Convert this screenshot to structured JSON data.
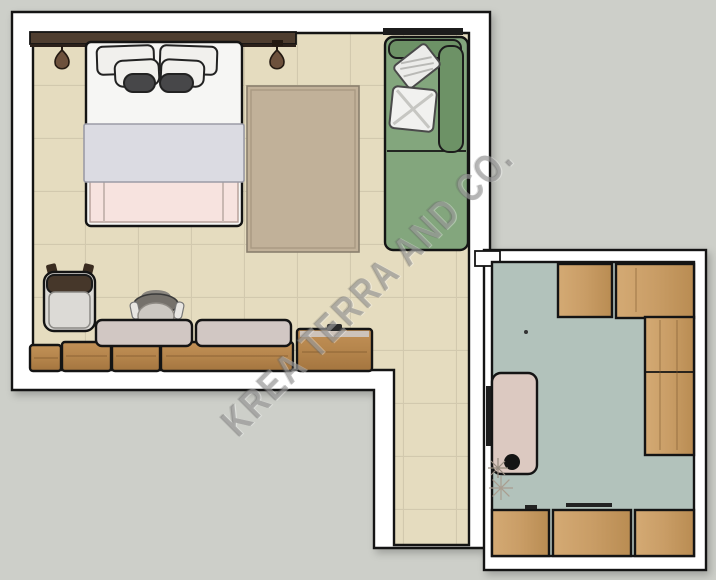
{
  "watermark": {
    "text": "KREA TERRA AND CO."
  },
  "colors": {
    "background": "#cdcfc9",
    "outline": "#141414",
    "wall_fill": "#ffffff",
    "tile_floor": "#e5dcbf",
    "tile_grout": "#d2c9ae",
    "room_b_floor": "#b2c2bb",
    "rug": "#c1b199",
    "sofa_green": "#83a67d",
    "sofa_green_dark": "#6d9266",
    "wood_bedroom": "#b5854c",
    "wood_closet": "#c99d66",
    "cushion_mauve": "#d1c7c3",
    "bed_white": "#f6f6f4",
    "pillow_white": "#f1f0ed",
    "accent_pillow_dark": "#474749",
    "blanket_gray": "#dbdbe2",
    "throw_pink": "#f7e3df",
    "headboard_brown": "#4f3e30",
    "lamp_brown": "#6d513c",
    "desk_pink": "#dcc9c1",
    "chair_seat_gray": "#dcdad6",
    "chair_back_brown": "#46372a",
    "desk_chair_gray": "#75716b",
    "watermark_gray": "rgba(118,118,118,0.45)"
  },
  "rooms": {
    "room_a": {
      "name": "bedroom-living area",
      "floor": "beige ceramic tile",
      "furniture": [
        "headboard rail",
        "pendant lamp left",
        "pendant lamp right",
        "double bed with pillows and blanket",
        "area rug",
        "green sofa with two pillows",
        "wall rail",
        "lounge chair",
        "desk chair",
        "bench cushions",
        "wood sideboard",
        "wood side cabinet"
      ]
    },
    "corridor": {
      "name": "corridor",
      "floor": "beige ceramic tile",
      "furniture": []
    },
    "room_b": {
      "name": "closet-storage room",
      "floor": "green-gray concrete",
      "furniture": [
        "wardrobe cabinet small",
        "wardrobe cabinet large",
        "wardrobe column",
        "base cabinet row",
        "pink console desk",
        "plant in pot"
      ]
    }
  }
}
